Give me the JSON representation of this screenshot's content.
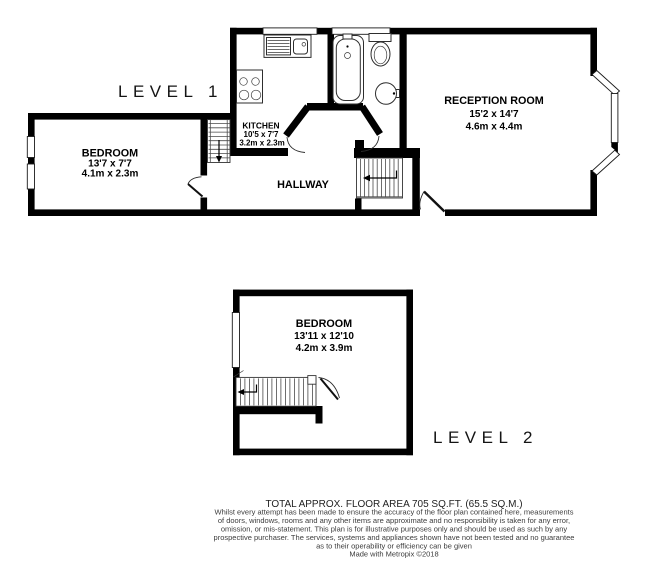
{
  "colors": {
    "wall": "#000000",
    "background": "#ffffff",
    "text": "#000000",
    "disclaimer": "#3c3c3c"
  },
  "level1": {
    "label": "LEVEL 1",
    "rooms": {
      "bedroom": {
        "name": "BEDROOM",
        "size_imperial": "13'7 x 7'7",
        "size_metric": "4.1m x 2.3m"
      },
      "kitchen": {
        "name": "KITCHEN",
        "size_imperial": "10'5 x 7'7",
        "size_metric": "3.2m x 2.3m"
      },
      "hallway": {
        "name": "HALLWAY"
      },
      "reception": {
        "name": "RECEPTION ROOM",
        "size_imperial": "15'2 x 14'7",
        "size_metric": "4.6m x 4.4m"
      }
    }
  },
  "level2": {
    "label": "LEVEL 2",
    "rooms": {
      "bedroom": {
        "name": "BEDROOM",
        "size_imperial": "13'11 x 12'10",
        "size_metric": "4.2m x 3.9m"
      }
    }
  },
  "footer": {
    "total_area": "TOTAL APPROX. FLOOR AREA 705 SQ.FT. (65.5 SQ.M.)",
    "disclaimer_lines": [
      "Whilst every attempt has been made to ensure the accuracy of the floor plan contained here, measurements",
      "of doors, windows, rooms and any other items are approximate and no responsibility is taken for any error,",
      "omission, or mis-statement. This plan is for illustrative purposes only and should be used as such by any",
      "prospective purchaser. The services, systems and appliances shown have not been tested and no guarantee",
      "as to their operability or efficiency can be given"
    ],
    "credit": "Made with Metropix ©2018"
  }
}
